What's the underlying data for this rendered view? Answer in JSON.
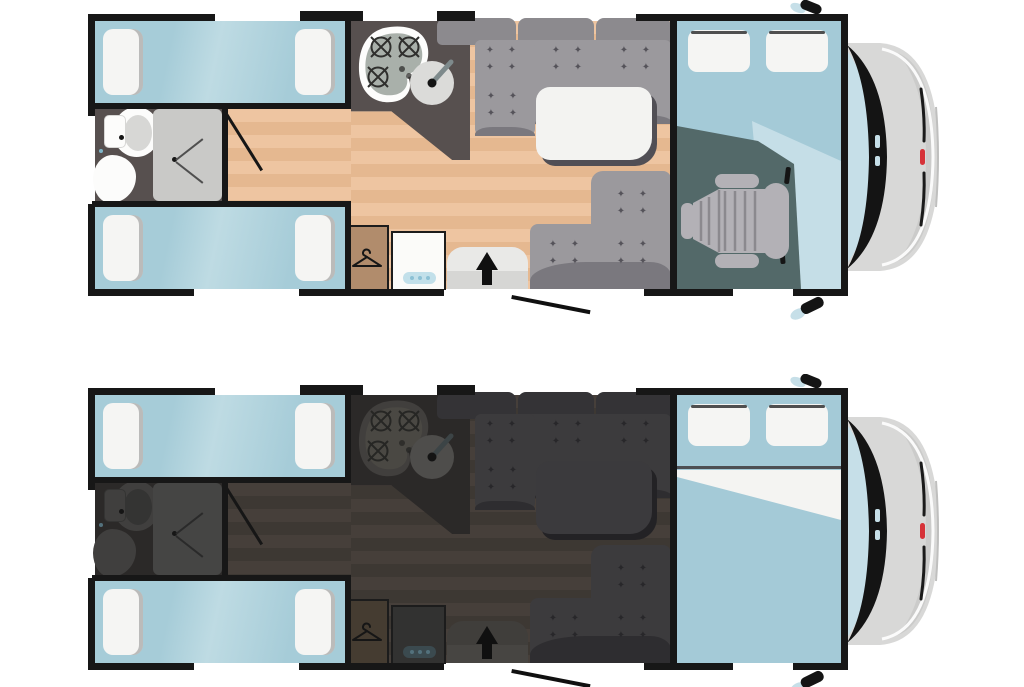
{
  "diagram": {
    "type": "motorhome-floorplan-top-view",
    "plans": [
      {
        "id": "floorplan-day",
        "variant": "day"
      },
      {
        "id": "floorplan-night",
        "variant": "night"
      }
    ],
    "icons": {
      "cushion_button": "✦",
      "entry_arrow": "up-arrow",
      "hanger": "clothes-hanger",
      "burner": "gas-burner",
      "wing_mirror": "wing-mirror"
    },
    "areas": {
      "rear_bedroom": [
        "single-bed-top",
        "single-bed-bottom",
        "pillows-x4"
      ],
      "bathroom": [
        "toilet",
        "washbasin",
        "shower",
        "bathroom-door"
      ],
      "kitchen": [
        "three-burner-hob",
        "round-sink",
        "worktop"
      ],
      "lounge": [
        "sofa-backrest",
        "l-shaped-dinette-sofa",
        "corner-sofa",
        "table"
      ],
      "storage": [
        "wardrobe",
        "fridge"
      ],
      "entrance": [
        "entry-mat",
        "entry-step",
        "entry-arrow",
        "habitation-door-open"
      ],
      "cab": [
        "over-cab-drop-down-bed",
        "pillows-x2",
        "cab-seat",
        "cab-floor",
        "windscreen"
      ],
      "exterior": [
        "vehicle-front",
        "wing-mirror-top",
        "wing-mirror-bottom",
        "windscreen-glass",
        "front-badge"
      ]
    }
  },
  "colors": {
    "common": {
      "wall": "#171717",
      "pillow": "#f5f5f3",
      "pillow-edge": "#4f4f4f",
      "nose-body": "#d8d8d7",
      "nose-shade": "#c4c4c3",
      "nose-band": "#141414",
      "nose-glass": "#c6dfe8",
      "nose-red": "#d63238"
    },
    "day": {
      "bg-room": "#57504f",
      "floor-a": "#eec5a1",
      "floor-b": "#e5b890",
      "bed-blue-a": "#bedbe3",
      "bed-blue-b": "#a6ccd8",
      "sofa-seat": "#9b999d",
      "sofa-back": "#8c8a8e",
      "sofa-edge": "#7a787e",
      "sofa-plus": "#55535a",
      "table-top": "#f3f3f1",
      "table-shadow": "#514f55",
      "wardrobe": "#b18c6c",
      "fridge-body": "#fbfbf9",
      "fridge-handle": "#c2e0ea",
      "fridge-dot": "#8cc1d5",
      "mat-top": "#e9e9e7",
      "mat-bottom": "#d6d6d4",
      "hob-blob": "#fdfdfc",
      "hob-inner": "#a9b0aa",
      "burner": "#2f2f2d",
      "sink-disc": "#dbdbd9",
      "faucet": "#7e8a8c",
      "shower-tray": "#c9c9c7",
      "shower-line": "#4f4f4f",
      "fixture": "#fcfcfb",
      "fixture-inner": "#d7d7d5",
      "cab-floor": "#536969",
      "wedge": "#c5dee7",
      "seat-body": "#b3b1b6",
      "seat-line": "#8b898e",
      "cab-bed": "#a4cad7",
      "divider": "#4d4f53",
      "sheet": "#f4f4f2",
      "dot-blue": "#7fb6c9"
    },
    "night": {
      "bg-room": "#2b2928",
      "floor-a": "#463f3a",
      "floor-b": "#3d3833",
      "bed-blue-a": "#bedbe3",
      "bed-blue-b": "#a6ccd8",
      "sofa-seat": "#3c3b3d",
      "sofa-back": "#343336",
      "sofa-edge": "#2e2d30",
      "sofa-plus": "#28272a",
      "table-top": "#3b3a3d",
      "table-shadow": "#232225",
      "wardrobe": "#453c31",
      "fridge-body": "#323231",
      "fridge-handle": "#3b4a4f",
      "fridge-dot": "#53717c",
      "mat-top": "#403e3b",
      "mat-bottom": "#474542",
      "hob-blob": "#413f3d",
      "hob-inner": "#4a4843",
      "burner": "#262624",
      "sink-disc": "#4e4d4b",
      "faucet": "#3c4446",
      "shower-tray": "#454544",
      "shower-line": "#2a2a2a",
      "fixture": "#403f3e",
      "fixture-inner": "#343433",
      "cab-floor": "#536969",
      "wedge": "#c5dee7",
      "seat-body": "#b3b1b6",
      "seat-line": "#8b898e",
      "cab-bed": "#a4cad7",
      "divider": "#4d4f53",
      "sheet": "#f4f4f2",
      "dot-blue": "#53717c"
    }
  }
}
